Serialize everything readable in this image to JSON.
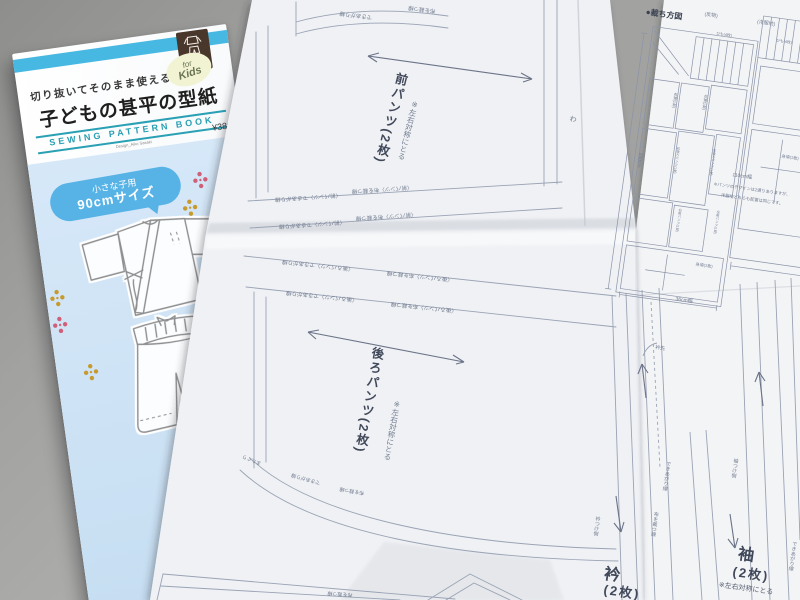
{
  "booklet": {
    "tagline": "切り抜いてそのまま使える!",
    "kids_badge_line1": "for",
    "kids_badge_line2": "Kids",
    "title": "子どもの甚平の型紙",
    "series": "SEWING PATTERN BOOK",
    "designer": "Design_Aiko Sasaki",
    "price": "¥380",
    "logo_caption": "型紙BOOK",
    "size_badge_line1": "小さな子用",
    "size_badge_line2": "90cmサイズ"
  },
  "sheet": {
    "front_pants_label": "前パンツ(2枚)",
    "front_pants_note": "※左右対称にとる",
    "back_pants_label": "後ろパンツ(2枚)",
    "back_pants_note": "※左右対称にとる",
    "collar_name": "衿",
    "collar_count": "(2枚)",
    "sleeve_name": "袖",
    "sleeve_count": "(2枚)",
    "sleeve_note": "※左右対称にとる",
    "fold_mark": "わ",
    "collar_tip": "衿先",
    "finish_line": "できあがり線",
    "cut_line": "布を裁つ線",
    "crotch_label": "またぐり",
    "collar_attach_side": "衿つけ側",
    "sleeve_attach_side": "袖つけ側",
    "edge_front_finish": "〈前パンツ〉できあがり線",
    "edge_front_cut": "〈前パンツ〉布を裁つ線",
    "edge_back_finish": "〈後ろパンツ〉できあがり線",
    "edge_back_cut": "〈後ろパンツ〉布を裁つ線"
  },
  "cutting_diagram": {
    "title": "●裁ち方図",
    "header_left": "(反物)",
    "header_right": "(洋服地)",
    "dim_left": "250cm",
    "dim_right": "110cm幅",
    "dim_bottom": "36cm幅",
    "box_himo_1": "ひも(4枚)",
    "box_himo_2": "ひも(4枚)",
    "box_sode_r": "右袖(1枚)",
    "box_sode_l": "左袖(1枚)",
    "box_back_pants_r": "右後ろパンツ(1枚)",
    "box_back_pants_l": "左後ろパンツ(1枚)",
    "box_front_pants_r": "右前パンツ(1枚)",
    "box_front_pants_l": "左前パンツ(1枚)",
    "box_migoro_1": "身頃(1枚)",
    "box_migoro_2": "身頃(1枚)",
    "note_line1": "※パンツのデザインは2通りありますが、",
    "note_line2": "洋服地どちらも配置は同じです。"
  },
  "colors": {
    "accent_teal": "#2aa0b4",
    "cover_blue": "#cfe3f4",
    "stripe_cyan": "#47b8e2",
    "badge_blue": "#57b3e6",
    "logo_brown": "#4a372c",
    "print_blue_gray": "#707a8e"
  }
}
